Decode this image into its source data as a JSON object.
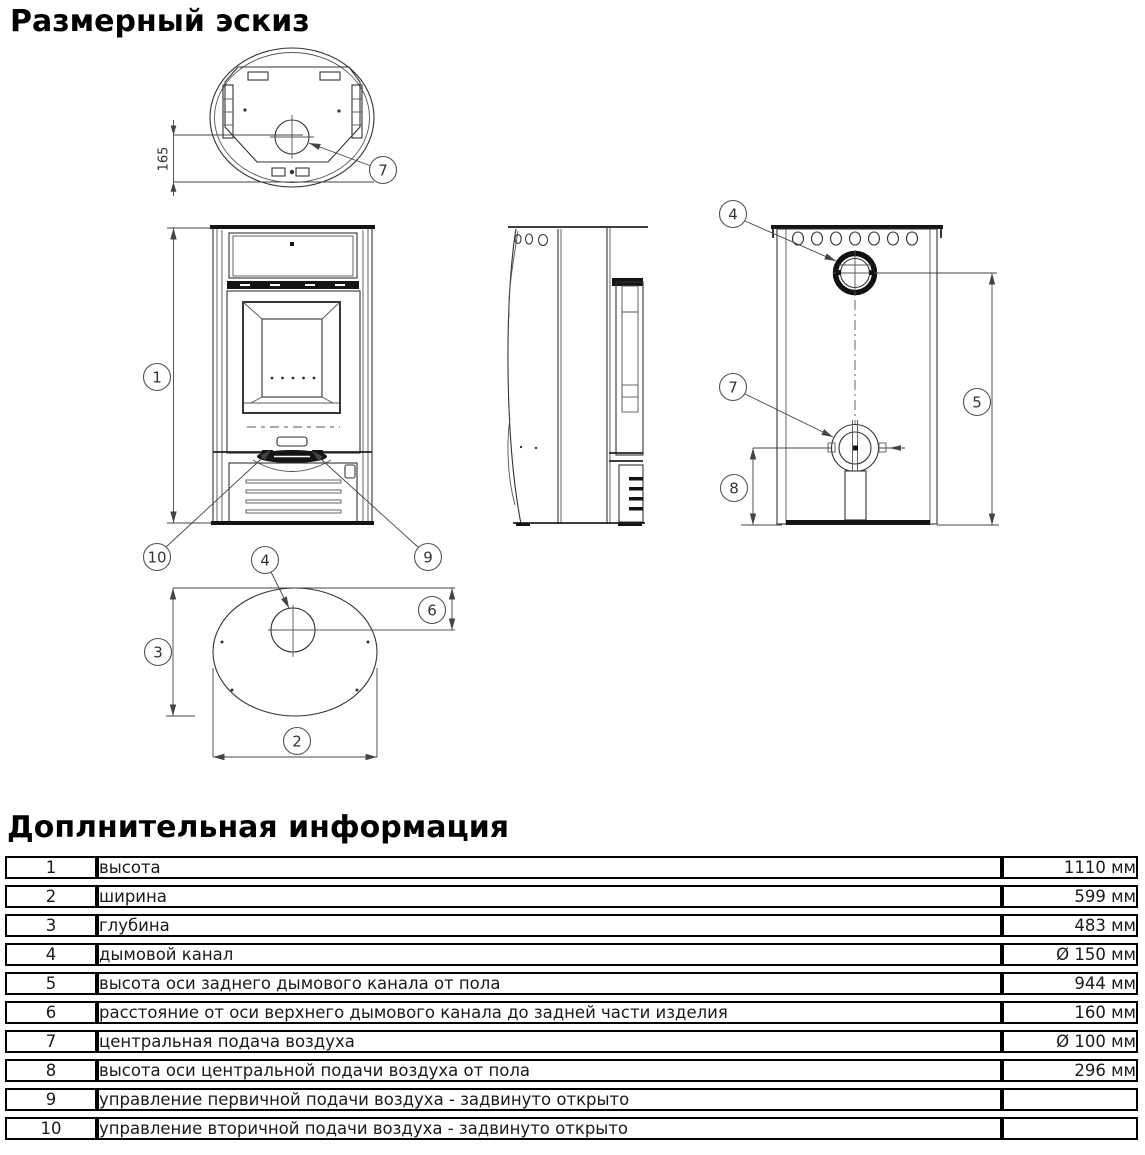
{
  "page": {
    "title": "Размерный эскиз",
    "table_title": "Доплнительная информация"
  },
  "drawing": {
    "dim_165": "165",
    "callouts": {
      "c1": "1",
      "c2": "2",
      "c3": "3",
      "c4": "4",
      "c5": "5",
      "c6": "6",
      "c7": "7",
      "c8": "8",
      "c9": "9",
      "c10": "10"
    }
  },
  "table": {
    "rows": [
      {
        "num": "1",
        "desc": "высота",
        "value": "1110 мм"
      },
      {
        "num": "2",
        "desc": "ширина",
        "value": "599 мм"
      },
      {
        "num": "3",
        "desc": "глубина",
        "value": "483 мм"
      },
      {
        "num": "4",
        "desc": "дымовой канал",
        "value": "Ø 150 мм"
      },
      {
        "num": "5",
        "desc": "высота оси заднего дымового канала от пола",
        "value": "944 мм"
      },
      {
        "num": "6",
        "desc": "расстояние от оси верхнего дымового канала до задней части изделия",
        "value": "160 мм"
      },
      {
        "num": "7",
        "desc": "центральная подача воздуха",
        "value": "Ø 100 мм"
      },
      {
        "num": "8",
        "desc": "высота оси центральной подачи воздуха от пола",
        "value": "296 мм"
      },
      {
        "num": "9",
        "desc": "управление первичной подачи воздуха - задвинуто открыто",
        "value": ""
      },
      {
        "num": "10",
        "desc": "управление вторичной подачи воздуха - задвинуто открыто",
        "value": ""
      }
    ]
  }
}
